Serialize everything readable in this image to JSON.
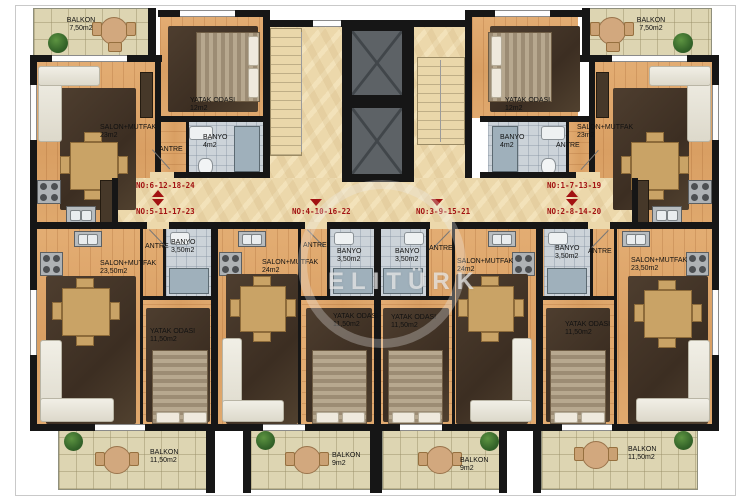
{
  "title": "apartment-floor-plan",
  "watermark": {
    "text": "ELITÜRK"
  },
  "palette": {
    "wall": "#161616",
    "wood": "#d99f63",
    "corridor": "#ecd8ab",
    "balcony_tile": "#ddd5b2",
    "bath_tile": "#ccd3d9",
    "unit_label_red": "#a21212",
    "rug_brown": "#4e3e2f"
  },
  "units": {
    "u6": {
      "label": "NO:6-12-18-24"
    },
    "u5": {
      "label": "NO:5-11-17-23"
    },
    "u4": {
      "label": "NO:4-10-16-22"
    },
    "u3": {
      "label": "NO:3-9-15-21"
    },
    "u1": {
      "label": "NO:1-7-13-19"
    },
    "u2": {
      "label": "NO:2-8-14-20"
    }
  },
  "rooms": {
    "tl_balkon": {
      "name": "BALKON",
      "area": "7,50m2"
    },
    "tl_salon": {
      "name": "SALON+MUTFAK",
      "area": "23m2"
    },
    "tl_yatak": {
      "name": "YATAK ODASI",
      "area": "12m2"
    },
    "tl_banyo": {
      "name": "BANYO",
      "area": "4m2"
    },
    "tl_antre": {
      "name": "ANTRE"
    },
    "tr_balkon": {
      "name": "BALKON",
      "area": "7,50m2"
    },
    "tr_salon": {
      "name": "SALON+MUTFAK",
      "area": "23m2"
    },
    "tr_yatak": {
      "name": "YATAK ODASI",
      "area": "12m2"
    },
    "tr_banyo": {
      "name": "BANYO",
      "area": "4m2"
    },
    "tr_antre": {
      "name": "ANTRE"
    },
    "b1_salon": {
      "name": "SALON+MUTFAK",
      "area": "23,50m2"
    },
    "b1_yatak": {
      "name": "YATAK ODASI",
      "area": "11,50m2"
    },
    "b1_banyo": {
      "name": "BANYO",
      "area": "3,50m2"
    },
    "b1_antre": {
      "name": "ANTRE"
    },
    "b1_balkon": {
      "name": "BALKON",
      "area": "11,50m2"
    },
    "b2_salon": {
      "name": "SALON+MUTFAK",
      "area": "24m2"
    },
    "b2_yatak": {
      "name": "YATAK ODASI",
      "area": "11,50m2"
    },
    "b2_banyo": {
      "name": "BANYO",
      "area": "3,50m2"
    },
    "b2_antre": {
      "name": "ANTRE"
    },
    "b2_balkon": {
      "name": "BALKON",
      "area": "9m2"
    },
    "b3_salon": {
      "name": "SALON+MUTFAK",
      "area": "24m2"
    },
    "b3_yatak": {
      "name": "YATAK ODASI",
      "area": "11,50m2"
    },
    "b3_banyo": {
      "name": "BANYO",
      "area": "3,50m2"
    },
    "b3_antre": {
      "name": "ANTRE"
    },
    "b3_balkon": {
      "name": "BALKON",
      "area": "9m2"
    },
    "b4_salon": {
      "name": "SALON+MUTFAK",
      "area": "23,50m2"
    },
    "b4_yatak": {
      "name": "YATAK ODASI",
      "area": "11,50m2"
    },
    "b4_banyo": {
      "name": "BANYO",
      "area": "3,50m2"
    },
    "b4_antre": {
      "name": "ANTRE"
    },
    "b4_balkon": {
      "name": "BALKON",
      "area": "11,50m2"
    }
  }
}
